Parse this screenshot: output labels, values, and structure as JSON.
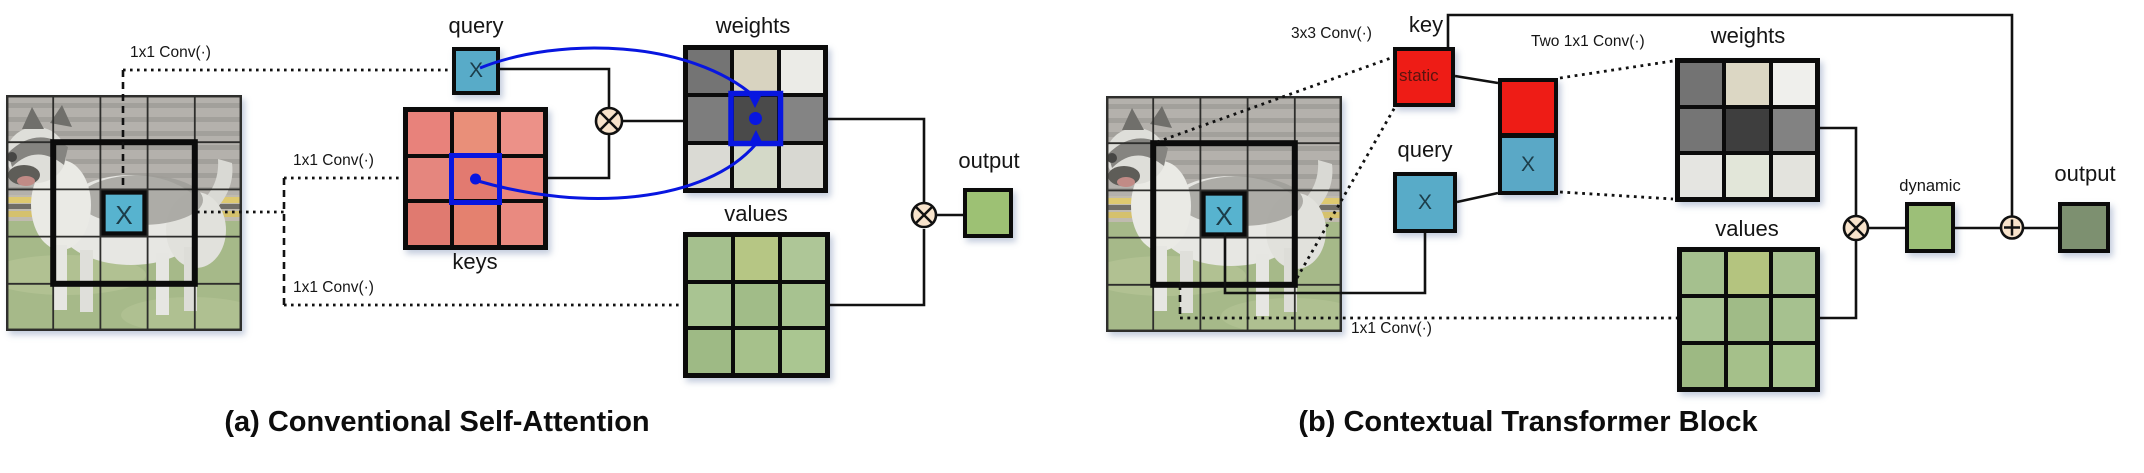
{
  "figure": {
    "colors": {
      "annotation_blue": "#0816e0",
      "query_blue": "#58abc8",
      "concat_blue": "#5aa8c6",
      "key_red": "#ee1c16",
      "operator_fill": "#f8e3cb",
      "output_a_green": "#9dc174",
      "dynamic_green": "#9cbf78",
      "output_b_green": "#7d9070"
    },
    "panel_a": {
      "caption": "(a) Conventional Self-Attention",
      "conv_label_query": "1x1 Conv(·)",
      "conv_label_keys": "1x1 Conv(·)",
      "conv_label_values": "1x1 Conv(·)",
      "input_x": "X",
      "query": {
        "label": "query",
        "x": "X"
      },
      "keys": {
        "label": "keys",
        "cells": [
          [
            "#e8827b",
            "#e98f79",
            "#ec9188"
          ],
          [
            "#e5867e",
            "#e27a70",
            "#ea867c"
          ],
          [
            "#e07a70",
            "#e4816f",
            "#e98a80"
          ]
        ]
      },
      "weights": {
        "label": "weights",
        "cells": [
          [
            "#747474",
            "#d8d3c0",
            "#ebebe7"
          ],
          [
            "#7d7d7d",
            "#4a4a4a",
            "#848484"
          ],
          [
            "#dadad4",
            "#d4d9c8",
            "#d8d8d2"
          ]
        ]
      },
      "values": {
        "label": "values",
        "cells": [
          [
            "#a5c08e",
            "#b6c684",
            "#aec697"
          ],
          [
            "#a9c492",
            "#a1bc88",
            "#a7c290"
          ],
          [
            "#9eba85",
            "#a6c18b",
            "#aac691"
          ]
        ]
      },
      "output": {
        "label": "output"
      }
    },
    "panel_b": {
      "caption": "(b) Contextual Transformer Block",
      "conv3x3_label": "3x3 Conv(·)",
      "two_conv_label": "Two 1x1 Conv(·)",
      "conv1x1_label": "1x1 Conv(·)",
      "input_x": "X",
      "key": {
        "label": "key",
        "tag": "static"
      },
      "query": {
        "label": "query",
        "x": "X"
      },
      "concat": {
        "x": "X"
      },
      "weights": {
        "label": "weights",
        "cells": [
          [
            "#737373",
            "#dcd7c4",
            "#efefec"
          ],
          [
            "#757575",
            "#3e3e3e",
            "#828282"
          ],
          [
            "#e5e5e1",
            "#e2e6d9",
            "#e3e3dd"
          ]
        ]
      },
      "values": {
        "label": "values",
        "cells": [
          [
            "#a5c08e",
            "#b4c47f",
            "#a8c190"
          ],
          [
            "#a8c392",
            "#a0bb87",
            "#a6c18f"
          ],
          [
            "#9db983",
            "#a5c08a",
            "#a9c590"
          ]
        ]
      },
      "dynamic": {
        "label": "dynamic"
      },
      "output": {
        "label": "output"
      }
    }
  }
}
